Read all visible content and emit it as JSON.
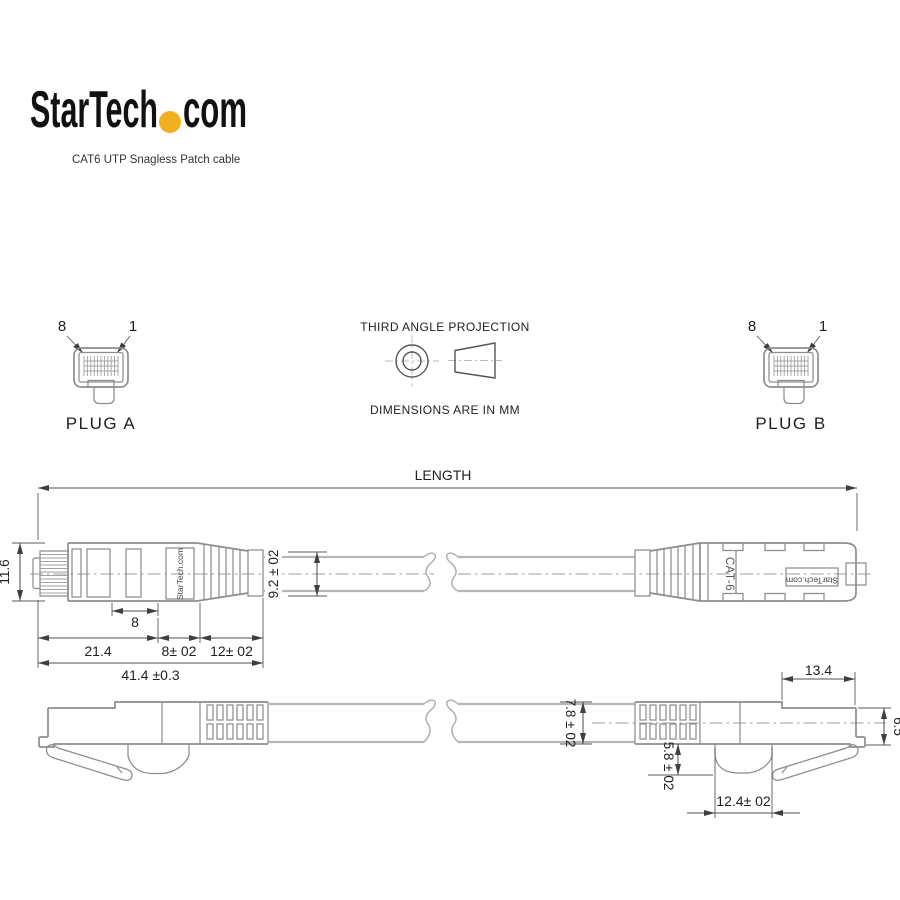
{
  "brand": {
    "logo_text_1": "StarTech",
    "logo_text_2": "com",
    "logo_dot_color": "#F2B01E",
    "subtitle": "CAT6 UTP Snagless Patch cable"
  },
  "projection_note": {
    "title": "THIRD ANGLE PROJECTION",
    "units": "DIMENSIONS ARE IN MM"
  },
  "plug_a": {
    "label": "PLUG A",
    "pin_first": "8",
    "pin_last": "1"
  },
  "plug_b": {
    "label": "PLUG B",
    "pin_first": "8",
    "pin_last": "1"
  },
  "side_view": {
    "length_label": "LENGTH",
    "plug_height": "11.6",
    "cable_diameter": "9.2 ± 02",
    "inner_segment": "8",
    "plug_body_length": "21.4",
    "boot_segment_1": "8± 02",
    "boot_segment_2": "12± 02",
    "overall_plug_length": "41.4 ±0.3",
    "marking_left": "StarTech.com",
    "marking_right_cat": "CAT-6",
    "marking_right_brand": "StarTech.com"
  },
  "bottom_view": {
    "cable_diameter": "7.8 ± 02",
    "latch_guard_depth": "5.8 ± 02",
    "latch_guard_width": "12.4± 02",
    "plug_front_length": "13.4",
    "plug_front_height": "6.5"
  },
  "colors": {
    "outline": "#8d8d8d",
    "dimension_line": "#4f4f4f",
    "text": "#1f1f1f",
    "cable": "#b6b6b6",
    "accent_dot": "#F2B01E"
  }
}
